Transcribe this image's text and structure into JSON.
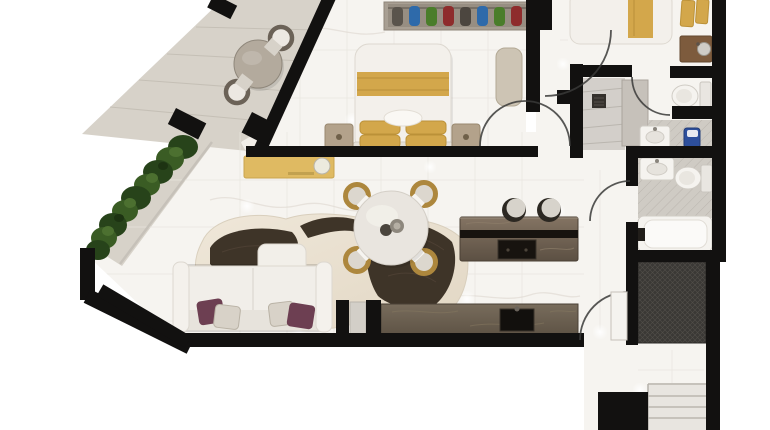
{
  "meta": {
    "kind": "3d-rendered-floor-plan",
    "description": "Top-down 3D architectural render of an apartment with diagonal terrace, no text labels visible",
    "background": "#ffffff"
  },
  "palette": {
    "wall": "#121110",
    "marble": "#f6f4f0",
    "marbleLine": "#e9e5df",
    "veinColor": "#ded9d1",
    "terraceFloor": "#d7d2c9",
    "terraceLine": "#c3bdb3",
    "glass": "#c5c0b8",
    "doorArc": "#3a3a38",
    "hedgeDark": "#27431a",
    "hedgeMid": "#3a5c24",
    "hedgeLight": "#4c7030",
    "sofa": "#f1eee9",
    "sofaShade": "#e4dfd7",
    "pillowMaroon": "#6d3f52",
    "pillowPattern": "#d8d2c8",
    "rugBase": "#ece3d4",
    "rugDark": "#3e3428",
    "gold": "#d3a74b",
    "goldDeep": "#bb9138",
    "consoleGold": "#dfba62",
    "chairGold": "#ad873d",
    "islandTop": "#7b6c5b",
    "islandDark": "#17130f",
    "counterTop": "#6b5f50",
    "stoolSeat": "#d7d3cb",
    "stoolBase": "#2c2822",
    "woodVanity": "#7d5b3d",
    "tileGrey": "#cfcbc4",
    "hatchGrey": "#b5b0a9",
    "fixtureWhite": "#f5f3ef",
    "fixtureLine": "#d0ccc5",
    "blueAccent": "#2d4f9c",
    "matDark": "#3a3835",
    "matLine": "#514e49",
    "stair": "#e8e5e0",
    "stairLine": "#c6c2bb",
    "nightstand": "#b3a28b",
    "bench": "#cdc4b4",
    "shelf": "#a89f93"
  },
  "bedroom1": {
    "wardrobe_clothes": [
      "#5a544c",
      "#2e6aaa",
      "#4a7d2a",
      "#8e2c2c",
      "#4c463f",
      "#2e6aaa",
      "#4a7d2a",
      "#8e2c2c"
    ],
    "furniture": [
      "open-wardrobe-with-clothes",
      "double-bed-gold-runner",
      "left-nightstand",
      "right-nightstand",
      "bench"
    ]
  },
  "rooms": [
    {
      "name": "terrace",
      "furniture": [
        "round-bistro-table",
        "terrace-chair-upper",
        "terrace-chair-lower",
        "hedge-planter"
      ]
    },
    {
      "name": "living-room",
      "furniture": [
        "white-sofa-with-chaise",
        "cowhide-rug",
        "gold-console",
        "maroon-pillows"
      ]
    },
    {
      "name": "dining-area",
      "furniture": [
        "round-dining-table",
        "four-gold-chairs",
        "decor-bowls"
      ]
    },
    {
      "name": "kitchen",
      "furniture": [
        "island-with-cooktop",
        "two-bar-stools",
        "counter-with-sink"
      ]
    },
    {
      "name": "bedroom-1",
      "furniture": [
        "bed",
        "wardrobe",
        "nightstands",
        "bench"
      ]
    },
    {
      "name": "bedroom-2-partial",
      "furniture": [
        "bed-gold-runner",
        "gold-towels",
        "wood-vanity"
      ]
    },
    {
      "name": "bathroom-1",
      "furniture": [
        "shower-with-drain",
        "marble-partition",
        "toilet",
        "sink",
        "blue-basket"
      ]
    },
    {
      "name": "bathroom-2",
      "furniture": [
        "sink",
        "toilet",
        "bathtub"
      ]
    },
    {
      "name": "utility-closet",
      "furniture": [
        "dark-tile-floor"
      ]
    },
    {
      "name": "stair-lobby",
      "furniture": [
        "dark-doormat",
        "staircase"
      ]
    }
  ]
}
